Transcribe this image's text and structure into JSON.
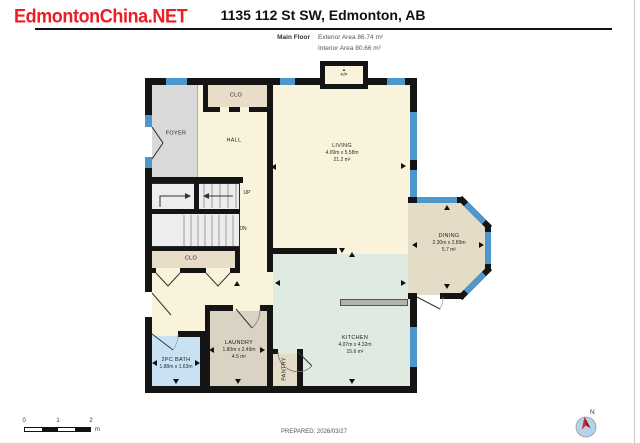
{
  "watermark": {
    "text": "EdmontonChina.NET",
    "color": "#ee1c25"
  },
  "header": {
    "title": "1135 112 St SW, Edmonton, AB",
    "floor_label": "Main Floor",
    "exterior_area": "Exterior Area 86.74 m²",
    "interior_area": "Interior Area 80.66 m²"
  },
  "rooms": {
    "living": {
      "name": "LIVING",
      "dims": "4.09m x 5.58m",
      "area": "21.2 m²"
    },
    "dining": {
      "name": "DINING",
      "dims": "2.30m x 2.89m",
      "area": "5.7 m²"
    },
    "kitchen": {
      "name": "KITCHEN",
      "dims": "4.07m x 4.32m",
      "area": "15.6 m²"
    },
    "laundry": {
      "name": "LAUNDRY",
      "dims": "1.80m x 2.49m",
      "area": "4.5 m²"
    },
    "bath": {
      "name": "2PC BATH",
      "dims": "1.88m x 1.63m"
    },
    "foyer": {
      "name": "FOYER"
    },
    "hall": {
      "name": "HALL"
    },
    "pantry": {
      "name": "PANTRY"
    },
    "closet_top": {
      "name": "CLO"
    },
    "closet_stairs": {
      "name": "CLO"
    },
    "fireplace": {
      "name": "F/P",
      "arrow_icon": "▲"
    },
    "stairs": {
      "up": "UP",
      "down": "DN"
    }
  },
  "footer": {
    "prepared": "PREPARED: 2026/03/27",
    "scale": {
      "t0": "0",
      "t1": "1",
      "t2": "2",
      "unit": "m"
    },
    "compass_n": "N"
  },
  "colors": {
    "wall": "#141414",
    "window": "#4e97cd",
    "cream": "#faf3dc",
    "tan": "#e5dcc8",
    "mint": "#dfeae1",
    "bath_blue": "#c9e2f3",
    "foyer_gray": "#d9d9d9",
    "counter_gray": "#b2b2b2",
    "watermark_red": "#ee1c25",
    "needle_red": "#d8232a",
    "compass_blue": "#b5d3e8"
  }
}
